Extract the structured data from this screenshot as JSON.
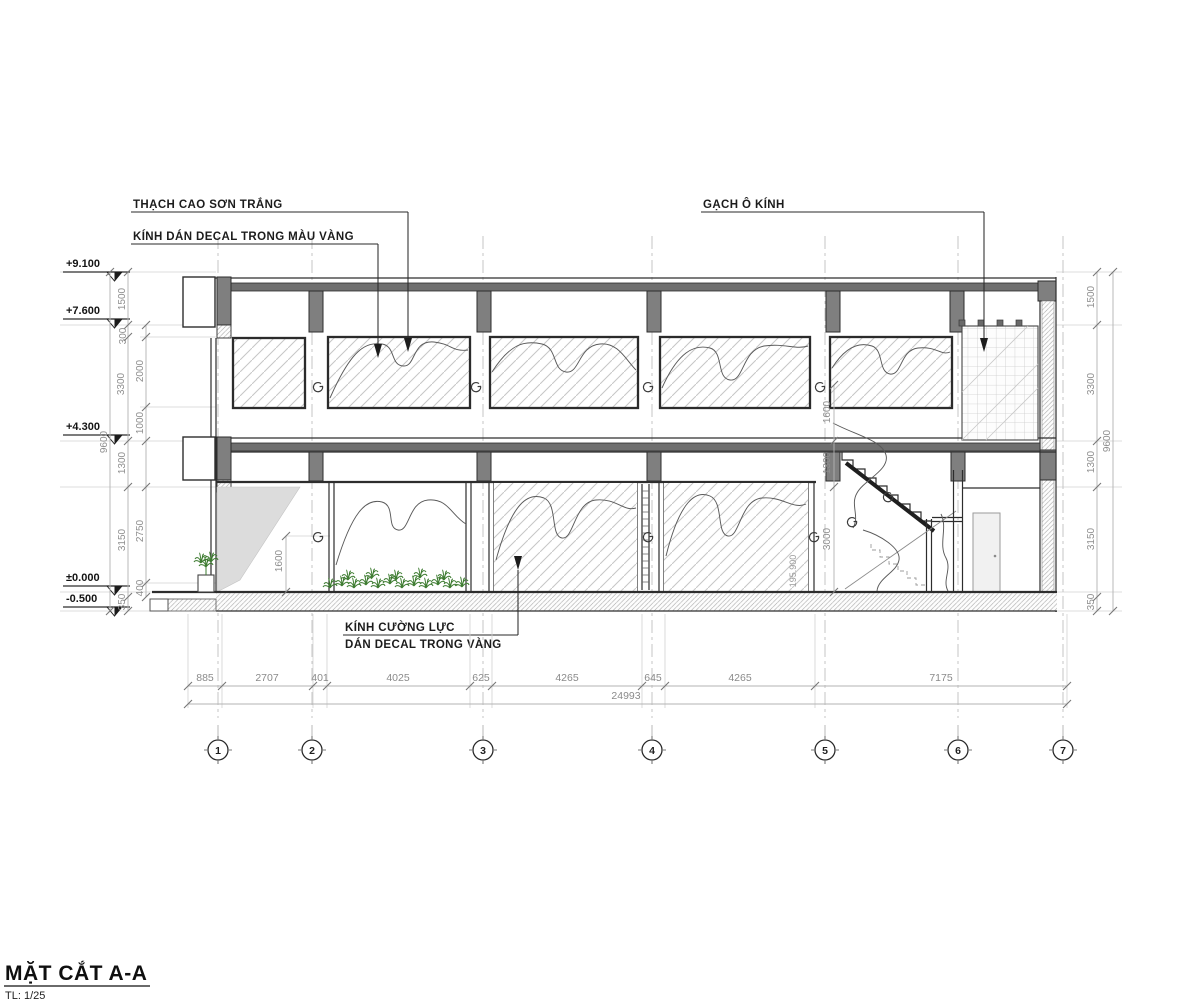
{
  "title_block": {
    "title": "MẶT CẮT A-A",
    "scale": "TL: 1/25"
  },
  "labels": {
    "plaster": "THẠCH CAO SƠN TRẮNG",
    "decal_glass": "KÍNH DÁN DECAL TRONG MÀU VÀNG",
    "glass_block": "GẠCH Ô KÍNH",
    "tempered_glass_line1": "KÍNH CƯỜNG LỰC",
    "tempered_glass_line2": "DÁN DECAL TRONG VÀNG"
  },
  "notes": {
    "wall_note": "195.900"
  },
  "elevations": [
    "+9.100",
    "+7.600",
    "+4.300",
    "±0.000",
    "-0.500"
  ],
  "dims": {
    "left_total": "9600",
    "right_total": "9600",
    "left_main": [
      "1500",
      "300",
      "3300",
      "1300",
      "3150",
      "350"
    ],
    "left_sub": [
      "2000",
      "1000",
      "2750",
      "400"
    ],
    "right_main": [
      "1500",
      "3300",
      "1300",
      "3150",
      "350"
    ],
    "stair": [
      "1600",
      "1300",
      "3000"
    ],
    "planter_height": "1600",
    "bottom_segments": [
      "885",
      "2707",
      "401",
      "4025",
      "625",
      "4265",
      "645",
      "4265",
      "7175"
    ],
    "bottom_total": "24993"
  },
  "grid_bubbles": [
    "1",
    "2",
    "3",
    "4",
    "5",
    "6",
    "7"
  ],
  "colors": {
    "cut_concrete": "#7f7f7f",
    "line_dark": "#2d2d2d",
    "dim_gray": "#8e8e8e",
    "plant_green": "#3e7c31",
    "door_fill": "#f1f1f1",
    "shade_gray": "#dcdcdc"
  }
}
